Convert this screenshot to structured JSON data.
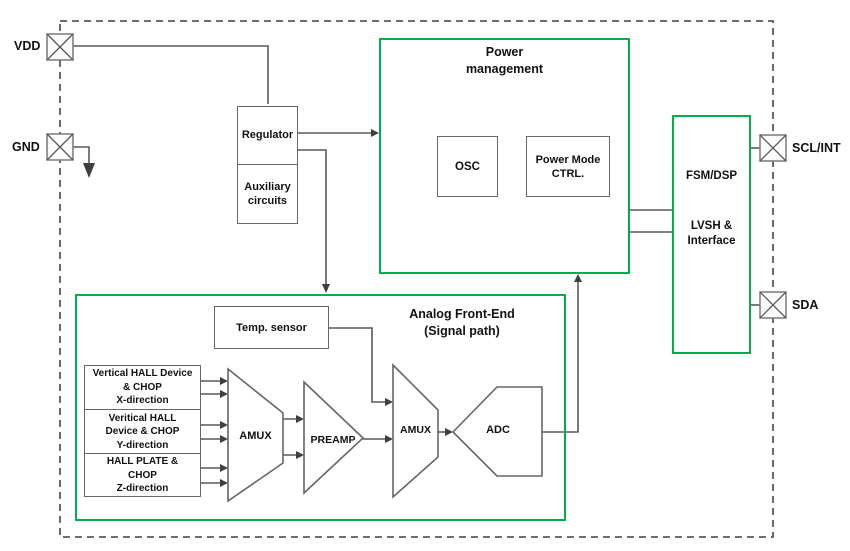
{
  "colors": {
    "block_green": "#00ad4e",
    "wire_gray": "#595959",
    "box_gray": "#666666"
  },
  "pins": {
    "vdd": "VDD",
    "gnd": "GND",
    "scl_int": "SCL/INT",
    "sda": "SDA"
  },
  "regulator_block": {
    "regulator": "Regulator",
    "auxiliary": [
      "Auxiliary",
      "circuits"
    ]
  },
  "power_management": {
    "title": [
      "Power",
      "management"
    ],
    "osc": "OSC",
    "power_mode_ctrl": [
      "Power Mode",
      "CTRL."
    ]
  },
  "fsm_block": {
    "fsm_dsp": "FSM/DSP",
    "lvsh_interface": [
      "LVSH &",
      "Interface"
    ]
  },
  "analog_front_end": {
    "title": [
      "Analog Front-End",
      "(Signal path)"
    ],
    "temp_sensor": "Temp. sensor",
    "hall_x": [
      "Vertical HALL Device",
      "& CHOP",
      "X-direction"
    ],
    "hall_y": [
      "Veritical HALL",
      "Device & CHOP",
      "Y-direction"
    ],
    "hall_z": [
      "HALL PLATE &",
      "CHOP",
      "Z-direction"
    ],
    "amux1": "AMUX",
    "preamp": "PREAMP",
    "amux2": "AMUX",
    "adc": "ADC"
  }
}
